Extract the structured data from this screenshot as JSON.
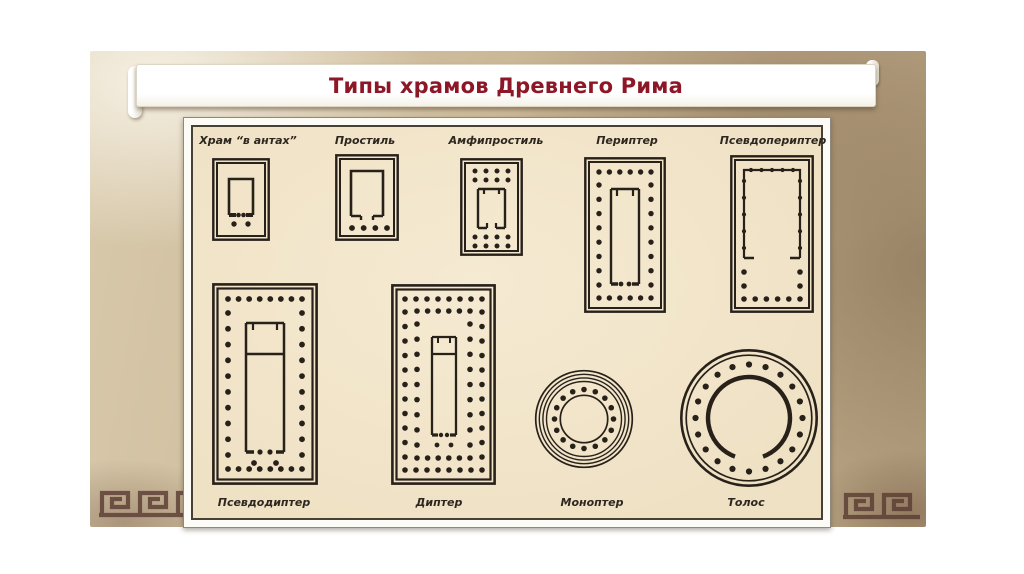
{
  "slide": {
    "title": "Типы храмов Древнего Рима"
  },
  "diagram": {
    "plans": [
      {
        "name": "khram-v-antakh",
        "label": "Храм “в антах”"
      },
      {
        "name": "prostil",
        "label": "Простиль"
      },
      {
        "name": "amfiprostil",
        "label": "Амфипростиль"
      },
      {
        "name": "peripter",
        "label": "Периптер"
      },
      {
        "name": "psevdoperipter",
        "label": "Псевдопериптер"
      },
      {
        "name": "psevdodipter",
        "label": "Псевдодиптер"
      },
      {
        "name": "dipter",
        "label": "Диптер"
      },
      {
        "name": "monopter",
        "label": "Моноптер"
      },
      {
        "name": "tolos",
        "label": "Толос"
      }
    ]
  },
  "colors": {
    "title_red": "#8d1726",
    "parchment_tan": "#cbb897",
    "panel_cream": "#f1e4c9",
    "ink_black": "#28211a",
    "meander_brown": "#5a3d33"
  }
}
